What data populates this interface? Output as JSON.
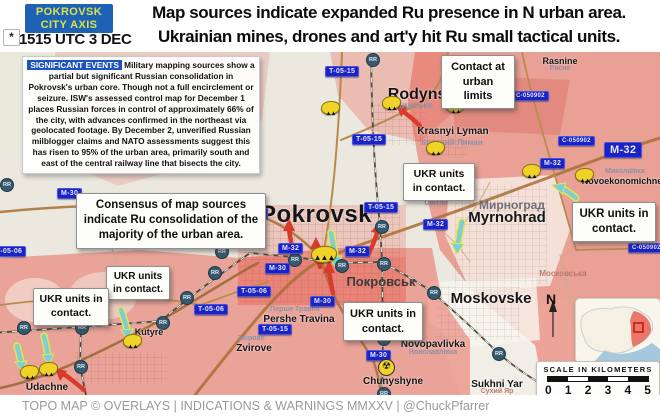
{
  "colors": {
    "axis_box_bg": "#1f62b5",
    "axis_box_text": "#d8e44a",
    "sig_tag_bg": "#1d53be",
    "road_label_bg": "#1b23c4",
    "red_zone": "#e4584a",
    "ru_arrow": "#d93a2b",
    "ukr_arrow": "#7fcdd6",
    "ukr_arrow_outline": "#dfe94f"
  },
  "header": {
    "axis_line1": "POKROVSK",
    "axis_line2": "CITY AXIS",
    "timestamp": "1515 UTC 3 DEC",
    "headline1": "Map sources indicate expanded Ru presence in N urban area.",
    "headline2": "Ukrainian mines, drones and art'y hit Ru small tactical units."
  },
  "sig_events": {
    "label": "SIGNIFICANT EVENTS",
    "body": " Military mapping sources show a partial but significant Russian consolidation in Pokrovsk's urban core. Though not a full encirclement or seizure. ISW's assessed control map for December 1 places Russian forces in control of approximately 66% of the city, with advances confirmed in the northeast via geolocated footage. By December 2, unverified Russian milblogger claims and NATO assessments suggest this has risen to 95% of the urban area, primarily south and east of the central railway line that bisects the city."
  },
  "callouts": {
    "contact_urban": "Contact at urban limits",
    "consensus": "Consensus of map sources indicate Ru consolidation of the majority of the urban area.",
    "ukr_contact": "UKR units in contact."
  },
  "places": {
    "pokrovsk": {
      "en": "Pokrovsk",
      "ua": "Покровськ"
    },
    "rodynske": {
      "en": "Rodynske",
      "ua": "Родинське"
    },
    "krasnyi_lyman": {
      "en": "Krasnyi Lyman",
      "ua": "Красний Лиман"
    },
    "rasnine": {
      "en": "Rasnine",
      "ua": "Рясне"
    },
    "myrnohrad": {
      "en": "Myrnohrad",
      "ua": "Мирноград"
    },
    "sville": {
      "en": "Sville",
      "ua": "Світле"
    },
    "novoekonomichne": {
      "en": "Novoekonomichne",
      "ua": "Миколаївка"
    },
    "moskovske": {
      "en": "Moskovske",
      "ua": "Московська"
    },
    "sukhni_yar": {
      "en": "Sukhni Yar",
      "ua": "Сухий Яр"
    },
    "novopavlivka": {
      "en": "Novopavlivka",
      "ua": "Новопавлівка"
    },
    "chunyshyne": {
      "en": "Chunyshyne"
    },
    "pershe_travina": {
      "en": "Pershe Travina",
      "ua": "Перше Травня"
    },
    "zvirove": {
      "en": "Zvirove",
      "ua": "Звірове"
    },
    "udachne": {
      "en": "Udachne"
    },
    "kutyre": {
      "en": "Kutyre"
    },
    "hryshyne_ua": "Гришине"
  },
  "roads": {
    "m30": "M-30",
    "m32": "M-32",
    "t0515": "T-05-15",
    "t0506": "T-05-06",
    "c050902": "C-050902"
  },
  "badges": {
    "rr": "RR"
  },
  "icons": {
    "asterisk": "*",
    "explosion": "▲▲",
    "explosion_big": "▲▲▲",
    "radiation": "☢"
  },
  "compass": {
    "label": "N"
  },
  "scale": {
    "title": "SCALE IN KILOMETERS",
    "ticks": [
      "0",
      "1",
      "2",
      "3",
      "4",
      "5"
    ]
  },
  "footer": {
    "credit": "TOPO MAP ©  OVERLAYS | INDICATIONS & WARNINGS MMXXV | @ChuckPfarrer"
  }
}
